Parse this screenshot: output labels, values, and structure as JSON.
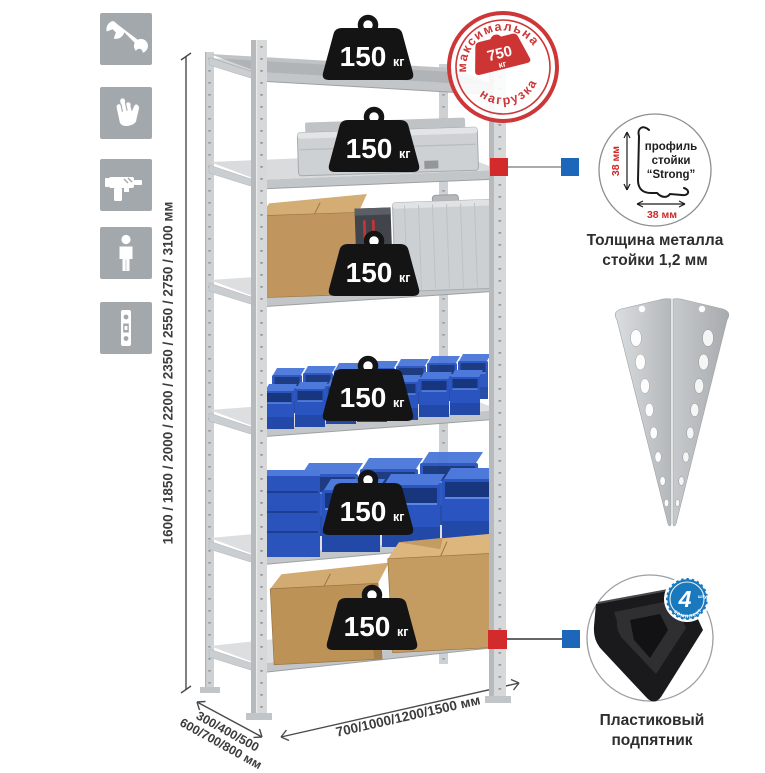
{
  "colors": {
    "icon_gray": "#a3a8ac",
    "metal_light": "#d6d8d9",
    "metal_mid": "#c2c6c8",
    "weight_black": "#141414",
    "stamp_red": "#cd3737",
    "bin_blue": "#2a55c0",
    "cardboard": "#c0965e",
    "connector_red": "#d32b2b",
    "connector_blue": "#1c67ba",
    "badge_blue": "#1a78bc",
    "dim_red": "#cc2a2a",
    "text_dark": "#3c3c3c"
  },
  "sidebar": {
    "icons": [
      {
        "name": "wrench-icon"
      },
      {
        "name": "gloves-icon"
      },
      {
        "name": "drill-icon"
      },
      {
        "name": "person-icon"
      },
      {
        "name": "level-icon"
      }
    ]
  },
  "dimensions": {
    "height_label": "1600 / 1850 / 2000 / 2200 / 2350 / 2550 / 2750 / 3100 мм",
    "depth_label_line1": "300/400/500",
    "depth_label_line2": "600/700/800 мм",
    "width_label": "700/1000/1200/1500 мм"
  },
  "shelf_load_badge": {
    "value": "150",
    "unit": "кг"
  },
  "max_load_stamp": {
    "arc_top": "максимальная",
    "arc_bottom": "нагрузка",
    "value": "750",
    "unit": "кг"
  },
  "post_profile": {
    "callout_line1": "профиль",
    "callout_line2": "стойки",
    "callout_line3": "“Strong”",
    "dim_vertical": "38 мм",
    "dim_horizontal": "38 мм",
    "caption_line1": "Толщина металла",
    "caption_line2": "стойки 1,2 мм"
  },
  "foot_detail": {
    "badge_value": "4",
    "badge_small_text": "штуки",
    "badge_arc_text": "в комплекте",
    "caption_line1": "Пластиковый",
    "caption_line2": "подпятник"
  }
}
